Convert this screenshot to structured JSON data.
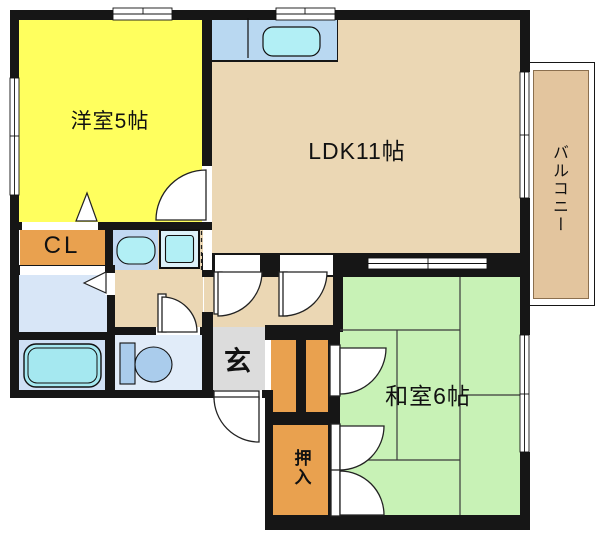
{
  "plan": {
    "title": "1LDK apartment floor plan",
    "rooms": {
      "western": {
        "label": "洋室5帖",
        "color": "#ffff5e"
      },
      "ldk": {
        "label": "LDK11帖",
        "color": "#ebd7b4"
      },
      "japanese": {
        "label": "和室6帖",
        "color": "#c8f2b6"
      },
      "balcony": {
        "label": "バルコニー",
        "color": "#e3c59e"
      },
      "closet": {
        "label": "CL",
        "color": "#e9a14f"
      },
      "genkan": {
        "label": "玄",
        "color": "#dcdcdc"
      },
      "oshiire": {
        "label": "押入",
        "color": "#e9a14f"
      },
      "hall": {
        "color": "#ebd7b4"
      },
      "washroom": {
        "color": "#d8e6f7"
      },
      "bathroom": {
        "color": "#cfe0f5"
      },
      "toilet": {
        "color": "#e1ecf9"
      },
      "kitchen_counter": {
        "color": "#b9d8f1"
      },
      "shoe_closet": {
        "color": "#e9a14f"
      }
    },
    "fixtures": {
      "sink": "#b2eff5",
      "tub": "#a5e8f0",
      "tub_room_unit": "#ddf2fa",
      "basin_unit": "#c2d9f2",
      "basin": "#b2eff5",
      "washer": "#b2eff5",
      "toilet_fixture": "#aaccec"
    },
    "wall_color": "#161616"
  }
}
